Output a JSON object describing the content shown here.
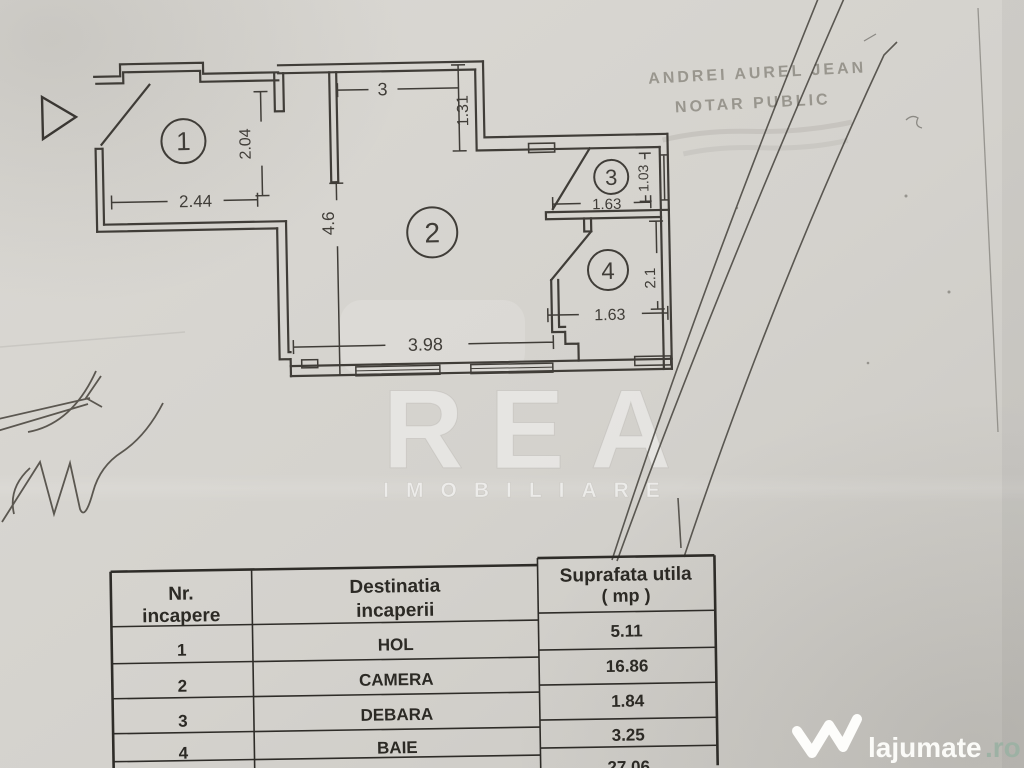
{
  "stamp": {
    "line1": "ANDREI AUREL JEAN",
    "line2": "NOTAR PUBLIC"
  },
  "plan": {
    "rooms": [
      {
        "number": "1"
      },
      {
        "number": "2"
      },
      {
        "number": "3"
      },
      {
        "number": "4"
      }
    ],
    "dims": {
      "d244": "2.44",
      "d204": "2.04",
      "d3": "3",
      "d131": "1.31",
      "d46": "4.6",
      "d398": "3.98",
      "d163_room3": "1.63",
      "d103": "1.03",
      "d163_room4": "1.63",
      "d21": "2.1"
    }
  },
  "table": {
    "headers": {
      "col1": [
        "Nr.",
        "incapere"
      ],
      "col2": [
        "Destinatia",
        "incaperii"
      ],
      "col3": [
        "Suprafata utila",
        "( mp )"
      ]
    },
    "rows": [
      {
        "nr": "1",
        "destination": "HOL",
        "area": "5.11"
      },
      {
        "nr": "2",
        "destination": "CAMERA",
        "area": "16.86"
      },
      {
        "nr": "3",
        "destination": "DEBARA",
        "area": "1.84"
      },
      {
        "nr": "4",
        "destination": "BAIE",
        "area": "3.25"
      }
    ],
    "total_partial": "27.06"
  },
  "watermark": {
    "brand": "REA",
    "subtitle": "IMOBILIARE"
  },
  "logo": {
    "name": "lajumate",
    "tld": ".ro"
  }
}
